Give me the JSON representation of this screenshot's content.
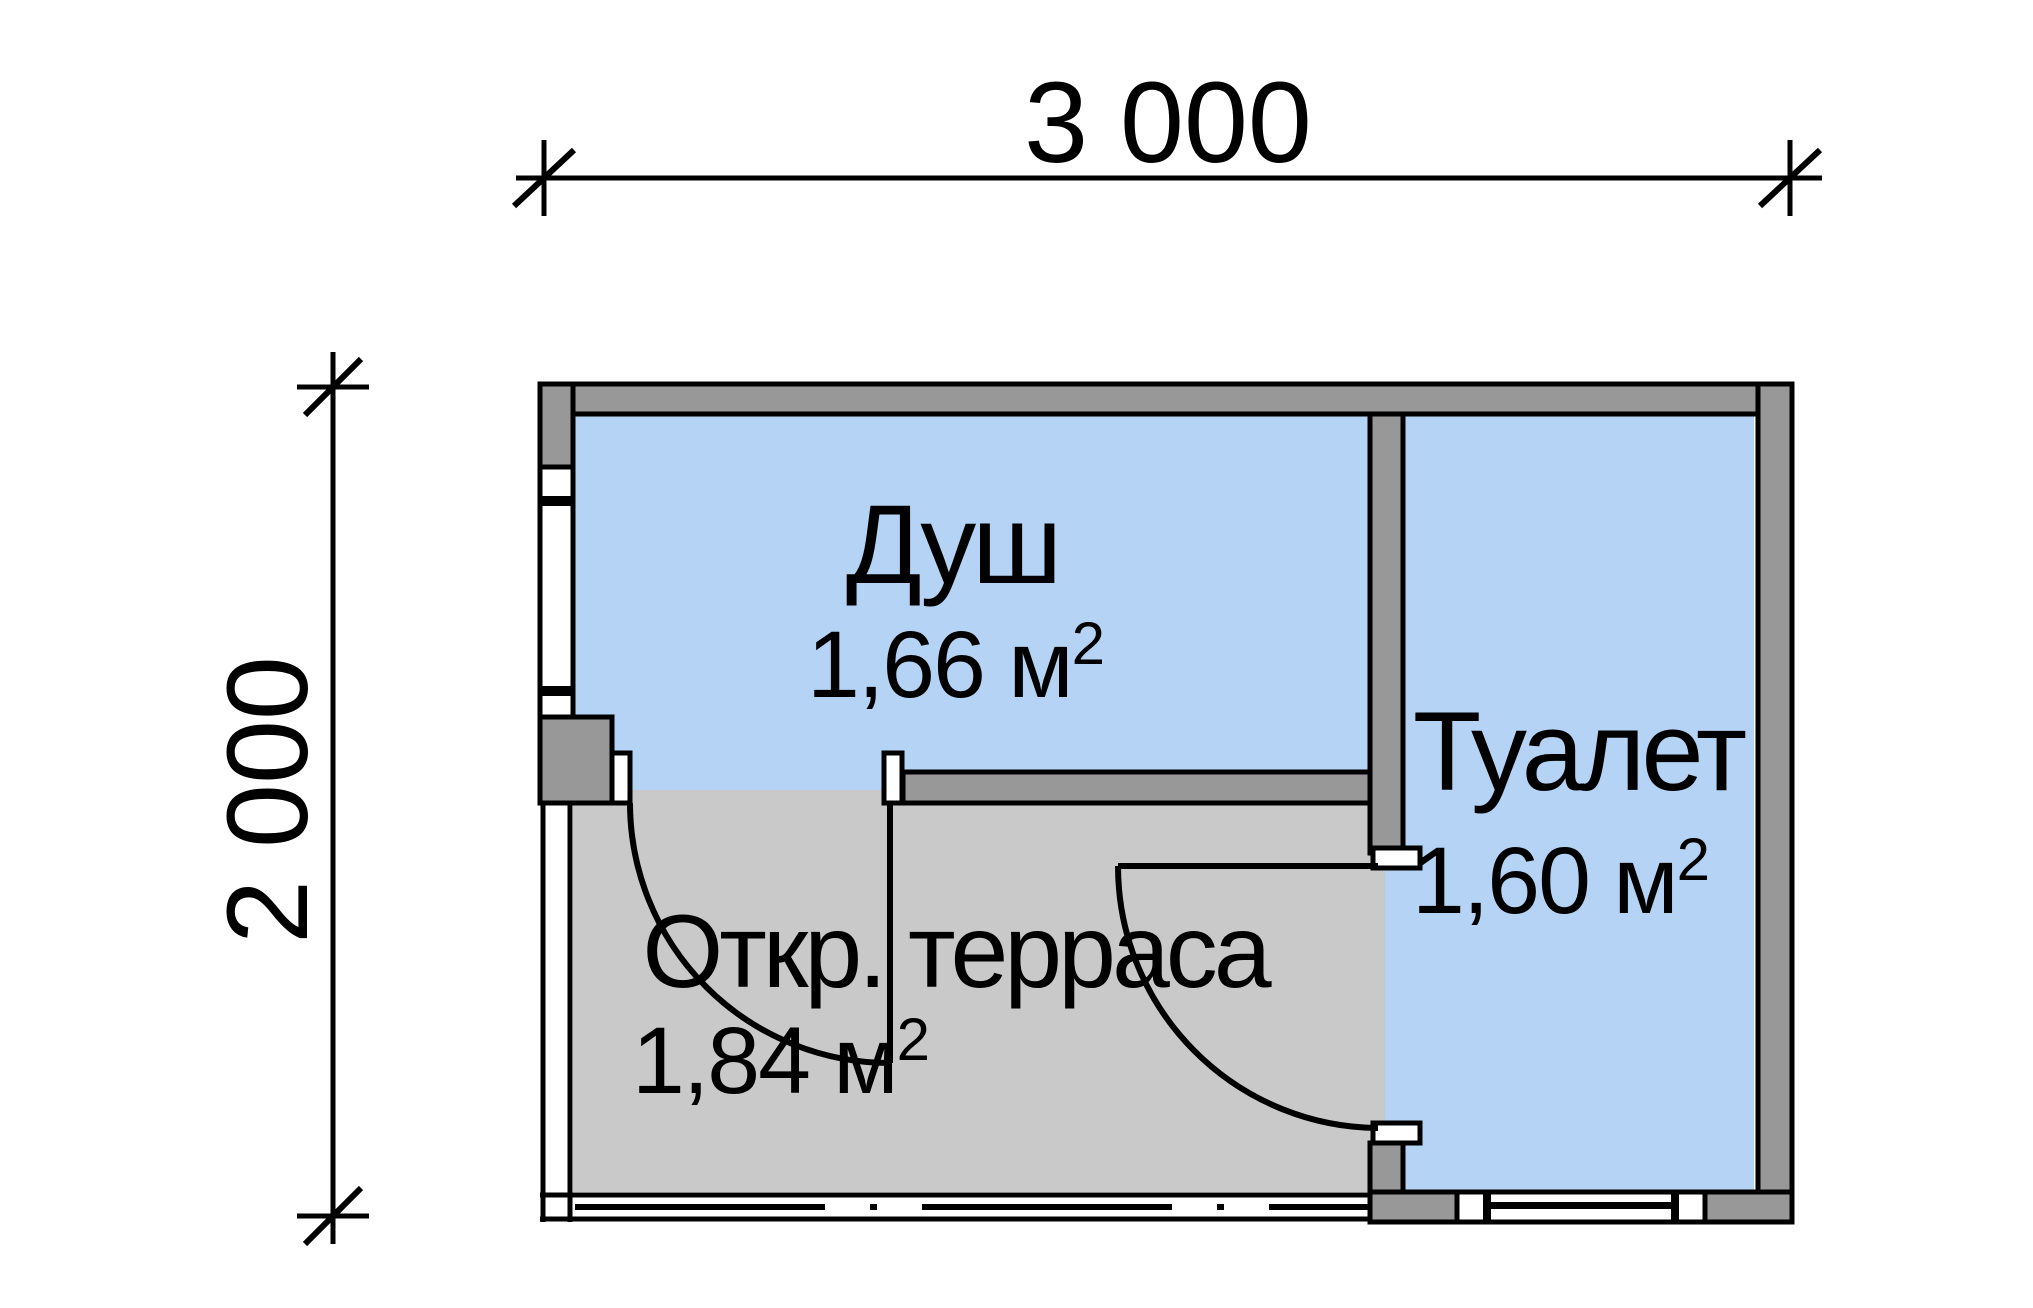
{
  "dimensions": {
    "width_label": "3 000",
    "height_label": "2 000"
  },
  "rooms": {
    "shower": {
      "name": "Душ",
      "area_base": "1,66 м",
      "area_exp": "2"
    },
    "toilet": {
      "name": "Туалет",
      "area_base": "1,60 м",
      "area_exp": "2"
    },
    "terrace": {
      "name": "Откр. терраса",
      "area_base": "1,84 м",
      "area_exp": "2"
    }
  },
  "colors": {
    "room_fill": "#b5d3f4",
    "terrace_fill": "#c9c9c9",
    "wall_fill": "#989898",
    "line": "#000000",
    "background": "#ffffff"
  }
}
